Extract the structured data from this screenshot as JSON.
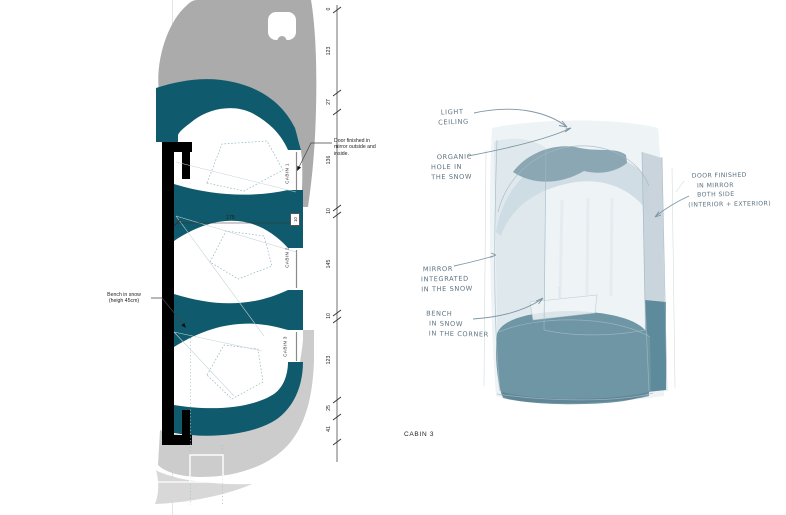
{
  "plan": {
    "cabin1_label": "CABIN 1",
    "cabin2_label": "CABIN 2",
    "cabin3_label": "CABIN 3",
    "door_note": [
      "Door finished in",
      "mirror outside and",
      "inside."
    ],
    "bench_note": [
      "Bench in snow",
      "(heigh 45cm)"
    ],
    "dim_vertical": [
      "0",
      "123",
      "27",
      "136",
      "10",
      "145",
      "10",
      "123",
      "25",
      "41"
    ],
    "dim_width": "175",
    "dim_wall": "10"
  },
  "sketch": {
    "caption": "CABIN 3",
    "light_ceiling": [
      "LIGHT",
      "CEILING"
    ],
    "organic_hole": [
      "ORGANIC",
      "HOLE IN",
      "THE SNOW"
    ],
    "mirror": [
      "MIRROR",
      "INTEGRATED",
      "IN THE SNOW"
    ],
    "bench": [
      "BENCH",
      "IN SNOW",
      "IN THE CORNER"
    ],
    "door": [
      "DOOR FINISHED",
      "IN MIRROR",
      "BOTH SIDE",
      "(INTERIOR + EXTERIOR)"
    ]
  },
  "colors": {
    "snow_wall_teal": "#0f5a6c",
    "hull_gray": "#ababab",
    "hull_gray_light": "#cccccc",
    "bench_slate": "#6e96a5",
    "ceiling_band": "#8ba7b4",
    "handwriting": "#5d7382"
  }
}
